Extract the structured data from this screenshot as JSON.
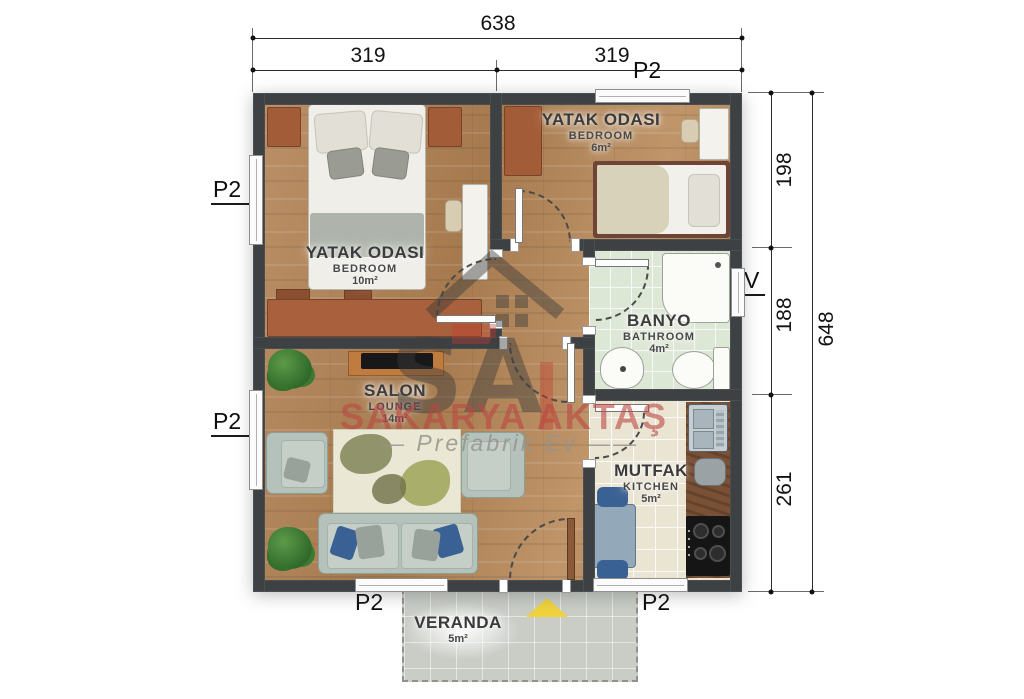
{
  "dims": {
    "top_total": "638",
    "top_segments": [
      "319",
      "319"
    ],
    "right_segments": [
      "198",
      "188",
      "261"
    ],
    "right_total": "648"
  },
  "markers": {
    "panel": "P2",
    "vent": "V"
  },
  "rooms": {
    "bedroom_main": {
      "name_tr": "YATAK ODASI",
      "name_en": "BEDROOM",
      "area": "10m²"
    },
    "bedroom_small": {
      "name_tr": "YATAK ODASI",
      "name_en": "BEDROOM",
      "area": "6m²"
    },
    "bathroom": {
      "name_tr": "BANYO",
      "name_en": "BATHROOM",
      "area": "4m²"
    },
    "lounge": {
      "name_tr": "SALON",
      "name_en": "LOUNGE",
      "area": "14m²"
    },
    "kitchen": {
      "name_tr": "MUTFAK",
      "name_en": "KITCHEN",
      "area": "5m²"
    },
    "veranda": {
      "name_tr": "VERANDA",
      "area": "5m²"
    }
  },
  "watermark": {
    "logo_text": "SA",
    "brand": "SAKARYA AKTAŞ",
    "tagline_prefix": "—",
    "tagline": "Prefabrik  Ev",
    "tagline_suffix": "——"
  },
  "colors": {
    "wall": "#3e4144",
    "wood_floor": "#b28a5f",
    "bathroom_floor": "#dde7d6",
    "kitchen_floor": "#eae4d2",
    "veranda_floor": "#c9cdc6",
    "watermark_red": "#ba4642",
    "entrance_triangle": "#efd23c"
  }
}
